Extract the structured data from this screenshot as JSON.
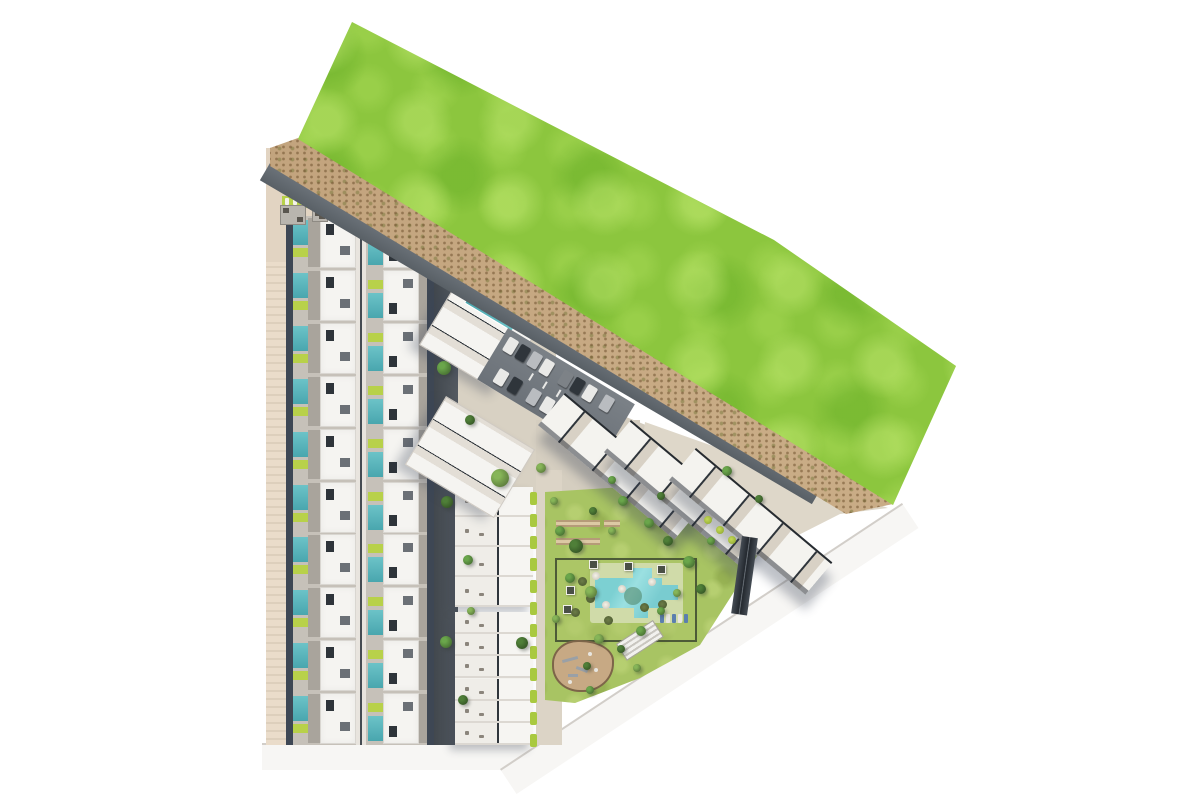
{
  "meta": {
    "description": "Aerial 3D architectural site plan rendering of a triangular residential development parcel: rows of townhouses with private pools on the west side, apartment blocks and a parking lot in the centre, a communal lawn with a large swimming pool, playground and picnic area, a paved corner plaza, and a large green field across a sandy buffer strip to the north-east. No text labels are visible.",
    "canvas_width": 1200,
    "canvas_height": 800
  },
  "palette": {
    "white_road": "#f7f6f4",
    "curb": "#d2cec9",
    "field_green": "#8cc63e",
    "sand": "#c9ac86",
    "paving_light": "#ded7c9",
    "lawn_green": "#a8c463",
    "lime_accent": "#b8d14a",
    "hedge_green": "#a9c93f",
    "pool_teal": "#58b6bd",
    "roof_white": "#f5f4f1",
    "terrace_gray": "#a9a49c",
    "shadow_slate": "#3e4754",
    "playground_sand": "#c7a984",
    "car_white": "#e9e9e7",
    "car_dark": "#2f353b",
    "car_silver": "#b9bcc0",
    "car_gray": "#7d8287",
    "tree_dark": "#4f7f38",
    "tree_mid": "#6aa64b",
    "tree_light": "#86b558"
  },
  "villas": {
    "rows": 10,
    "block": {
      "x": 286,
      "y": 216,
      "width": 148,
      "row_height": 52.9
    },
    "row_parts": [
      {
        "x": 0,
        "y": 0,
        "w": 7,
        "h": 53,
        "c": "shadow_slate"
      },
      {
        "x": 7,
        "y": 4,
        "w": 15,
        "h": 25,
        "c": "pool_teal"
      },
      {
        "x": 7,
        "y": 32,
        "w": 15,
        "h": 9,
        "c": "lime_accent"
      },
      {
        "x": 22,
        "y": 2,
        "w": 12,
        "h": 49,
        "c": "terrace_gray"
      },
      {
        "x": 34,
        "y": 1,
        "w": 36,
        "h": 51,
        "c": "roof_white",
        "cls": "villa-roof"
      },
      {
        "x": 40,
        "y": 8,
        "w": 8,
        "h": 11,
        "c": "#2e343a"
      },
      {
        "x": 54,
        "y": 30,
        "w": 10,
        "h": 9,
        "c": "#6b7076"
      },
      {
        "x": 70,
        "y": 0,
        "w": 10,
        "h": 53,
        "c": "#e8e4de"
      },
      {
        "x": 74,
        "y": 0,
        "w": 2,
        "h": 53,
        "c": "#454b52"
      },
      {
        "x": 82,
        "y": 24,
        "w": 15,
        "h": 25,
        "c": "pool_teal"
      },
      {
        "x": 82,
        "y": 11,
        "w": 15,
        "h": 9,
        "c": "lime_accent"
      },
      {
        "x": 97,
        "y": 1,
        "w": 36,
        "h": 51,
        "c": "roof_white",
        "cls": "villa-roof"
      },
      {
        "x": 103,
        "y": 34,
        "w": 8,
        "h": 11,
        "c": "#2e343a"
      },
      {
        "x": 117,
        "y": 10,
        "w": 10,
        "h": 9,
        "c": "#6b7076"
      },
      {
        "x": 133,
        "y": 2,
        "w": 12,
        "h": 49,
        "c": "terrace_gray"
      },
      {
        "x": 141,
        "y": 0,
        "w": 7,
        "h": 53,
        "c": "shadow_slate"
      }
    ]
  },
  "mid_column_blocks": [
    {
      "x": 455,
      "y": 487,
      "width": 78,
      "height": 120,
      "units": 4
    },
    {
      "x": 455,
      "y": 612,
      "width": 78,
      "height": 133,
      "units": 6
    }
  ],
  "tilted_blocks": [
    {
      "x": 452,
      "y": 290,
      "w": 94,
      "h": 64,
      "angle": 31,
      "has_pool": true
    },
    {
      "x": 446,
      "y": 396,
      "w": 104,
      "h": 80,
      "angle": 31,
      "has_pool": false
    }
  ],
  "angled_rows": [
    {
      "x": 565,
      "y": 393
    },
    {
      "x": 631,
      "y": 420
    },
    {
      "x": 696,
      "y": 448
    }
  ],
  "parking_cars": [
    {
      "u": 6,
      "v": 6,
      "c": "car_white"
    },
    {
      "u": 20,
      "v": 6,
      "c": "car_dark"
    },
    {
      "u": 34,
      "v": 6,
      "c": "car_silver"
    },
    {
      "u": 48,
      "v": 6,
      "c": "car_white"
    },
    {
      "u": 70,
      "v": 6,
      "c": "car_gray"
    },
    {
      "u": 84,
      "v": 6,
      "c": "car_dark"
    },
    {
      "u": 98,
      "v": 6,
      "c": "car_white"
    },
    {
      "u": 118,
      "v": 6,
      "c": "car_silver"
    },
    {
      "u": 14,
      "v": 38,
      "c": "car_white"
    },
    {
      "u": 30,
      "v": 38,
      "c": "car_dark"
    },
    {
      "u": 52,
      "v": 38,
      "c": "car_silver"
    },
    {
      "u": 68,
      "v": 38,
      "c": "car_white"
    },
    {
      "u": 90,
      "v": 38,
      "c": "car_dark"
    },
    {
      "u": 106,
      "v": 38,
      "c": "car_silver"
    }
  ],
  "lane_marks": [
    {
      "u": 44,
      "v": 26
    },
    {
      "u": 60,
      "v": 26
    },
    {
      "u": 76,
      "v": 26
    }
  ],
  "picnic_tables": [
    {
      "x": 556,
      "y": 520,
      "w": 44,
      "h": 7
    },
    {
      "x": 556,
      "y": 538,
      "w": 44,
      "h": 7
    },
    {
      "x": 604,
      "y": 520,
      "w": 16,
      "h": 7
    }
  ],
  "cabanas": [
    [
      589,
      560
    ],
    [
      624,
      562
    ],
    [
      657,
      565
    ],
    [
      566,
      586
    ],
    [
      563,
      605
    ]
  ],
  "umbrellas_dark": [
    [
      578,
      577
    ],
    [
      586,
      594
    ],
    [
      604,
      616
    ],
    [
      640,
      603
    ],
    [
      658,
      600
    ],
    [
      571,
      608
    ]
  ],
  "umbrellas_light": [
    [
      592,
      572
    ],
    [
      618,
      585
    ],
    [
      648,
      578
    ],
    [
      602,
      601
    ]
  ],
  "lounger_row": {
    "count": 5,
    "colors": [
      "#5b7fae",
      "#e8e6e0"
    ]
  },
  "hedge_dashes": {
    "x": 530,
    "y_start": 492,
    "y_end": 742,
    "step": 22
  },
  "lime_shrubs": [
    [
      704,
      516
    ],
    [
      716,
      526
    ],
    [
      728,
      536
    ]
  ],
  "strip_loungers": 5,
  "sofa_sets": [
    {
      "x": 280,
      "y": 205,
      "w": 26,
      "h": 20
    },
    {
      "x": 312,
      "y": 208,
      "w": 16,
      "h": 14
    }
  ],
  "playground_marks": [
    {
      "x": 8,
      "y": 16,
      "w": 16,
      "h": 2.5,
      "rot": -15
    },
    {
      "x": 22,
      "y": 26,
      "w": 12,
      "h": 2.5,
      "rot": 20
    },
    {
      "x": 14,
      "y": 32,
      "w": 10,
      "h": 2.5,
      "rot": 0
    }
  ],
  "trees": [
    [
      444,
      368,
      7,
      1
    ],
    [
      447,
      502,
      6,
      0
    ],
    [
      446,
      642,
      6,
      1
    ],
    [
      463,
      700,
      5,
      0
    ],
    [
      500,
      478,
      9,
      2
    ],
    [
      522,
      643,
      6,
      0
    ],
    [
      541,
      468,
      5,
      2
    ],
    [
      470,
      420,
      5,
      0
    ],
    [
      468,
      560,
      5,
      1
    ],
    [
      471,
      611,
      4,
      2
    ],
    [
      560,
      531,
      5,
      1
    ],
    [
      576,
      546,
      7,
      0
    ],
    [
      591,
      592,
      6,
      2
    ],
    [
      570,
      578,
      5,
      1
    ],
    [
      612,
      531,
      4,
      2
    ],
    [
      649,
      523,
      5,
      1
    ],
    [
      668,
      541,
      5,
      0
    ],
    [
      689,
      562,
      6,
      1
    ],
    [
      701,
      589,
      5,
      0
    ],
    [
      677,
      593,
      4,
      2
    ],
    [
      641,
      631,
      5,
      1
    ],
    [
      621,
      649,
      4,
      0
    ],
    [
      599,
      639,
      5,
      2
    ],
    [
      661,
      611,
      4,
      1
    ],
    [
      633,
      596,
      9,
      3
    ],
    [
      711,
      541,
      4,
      1
    ],
    [
      587,
      666,
      4,
      0
    ],
    [
      556,
      619,
      4,
      2
    ],
    [
      554,
      501,
      4,
      2
    ],
    [
      623,
      501,
      5,
      1
    ],
    [
      593,
      511,
      4,
      0
    ],
    [
      612,
      480,
      4,
      1
    ],
    [
      661,
      496,
      4,
      0
    ],
    [
      637,
      668,
      4,
      2
    ],
    [
      590,
      690,
      4,
      1
    ],
    [
      727,
      471,
      5,
      1
    ],
    [
      759,
      499,
      4,
      0
    ],
    [
      281,
      167,
      5,
      1
    ],
    [
      342,
      201,
      4,
      2
    ],
    [
      359,
      215,
      4,
      1
    ]
  ]
}
